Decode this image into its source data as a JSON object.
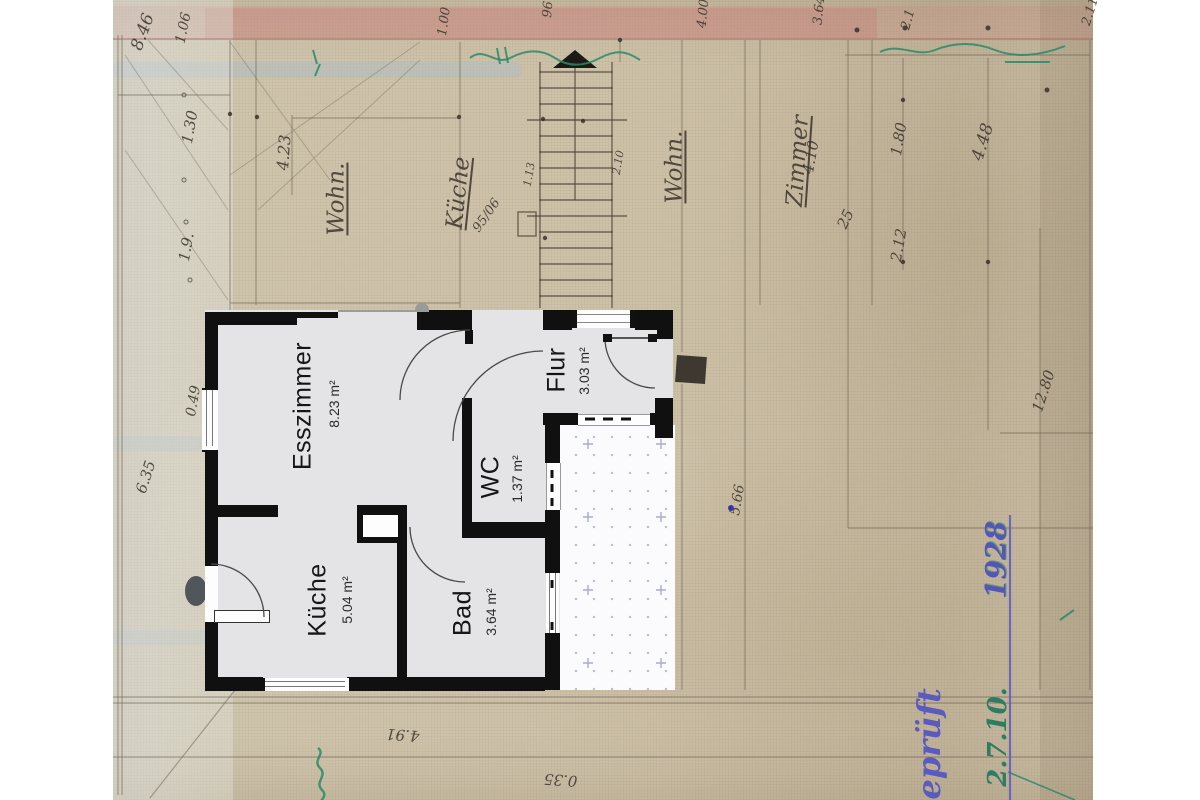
{
  "floor_plan": {
    "rooms": [
      {
        "id": "esszimmer",
        "name": "Esszimmer",
        "area": "8.23 m²"
      },
      {
        "id": "flur",
        "name": "Flur",
        "area": "3.03 m²"
      },
      {
        "id": "wc",
        "name": "WC",
        "area": "1.37 m²"
      },
      {
        "id": "kueche",
        "name": "Küche",
        "area": "5.04 m²"
      },
      {
        "id": "bad",
        "name": "Bad",
        "area": "3.64 m²"
      }
    ]
  },
  "bg": {
    "labels": [
      "Wohn.",
      "Küche",
      "95/06",
      "Wohn.",
      "Zimmer"
    ],
    "dims": [
      "8.46",
      "1.06",
      "1.30",
      "1.9.",
      "0.49",
      "4.23",
      "6.35",
      "4.10",
      "25",
      "2.12",
      "1.80",
      "4.48",
      "2.1",
      "12.80",
      "5.66",
      "4.91",
      "0.35",
      "1.00",
      "96",
      "4.00",
      "3.64",
      "2.11",
      "2.10",
      "1.13"
    ],
    "stamp": {
      "gepr": "geprüft",
      "date": "2.7.10.",
      "year": "1928"
    }
  },
  "colors": {
    "paper": "#cdc1a8",
    "wall": "#101010",
    "floor": "#e4e4e6",
    "terrace_dot": "#8a8aaf",
    "ink_blue": "#5b5bbf",
    "ink_green": "#2a8a68",
    "red_band": "#c98b85",
    "pencil": "#3a342b"
  }
}
